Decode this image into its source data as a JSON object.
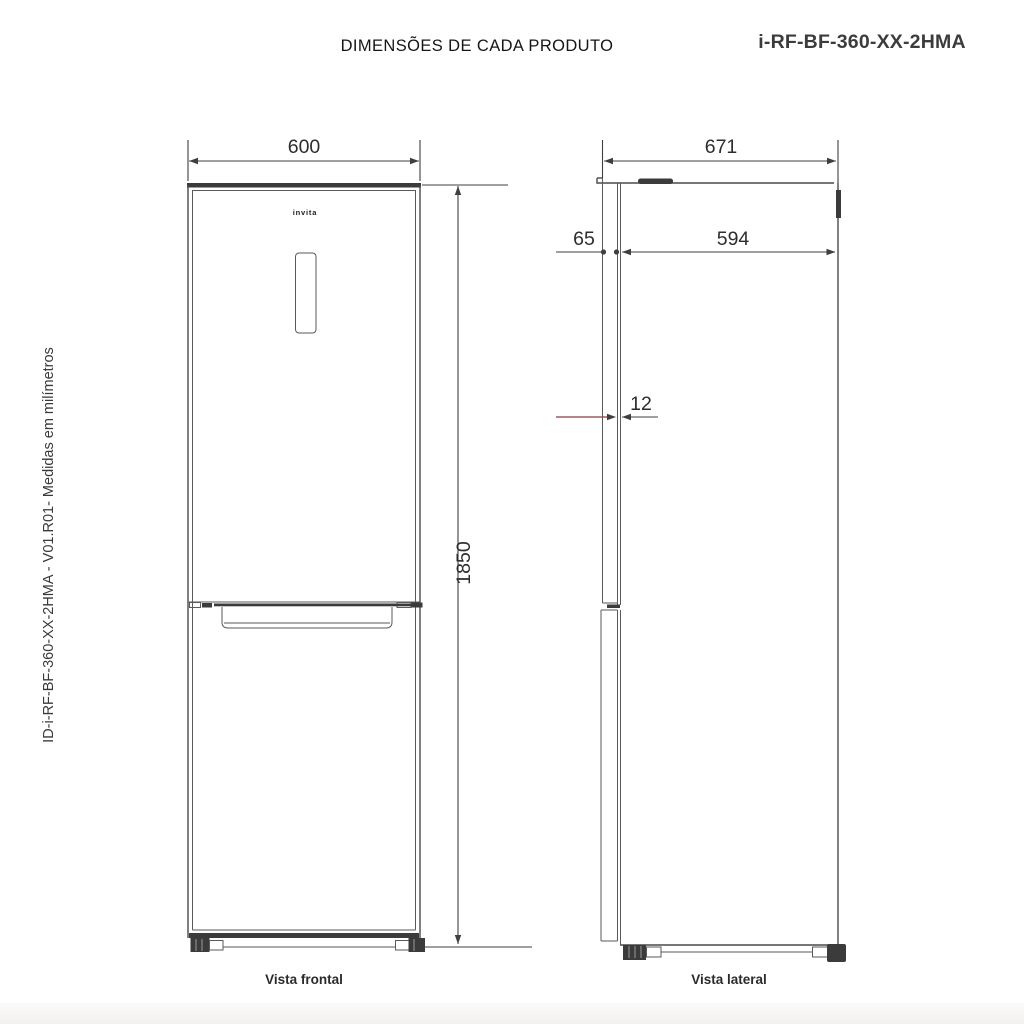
{
  "header": {
    "title": "DIMENSÕES DE CADA PRODUTO",
    "model": "i-RF-BF-360-XX-2HMA",
    "side_note": "ID-i-RF-BF-360-XX-2HMA - V01.R01- Medidas em milímetros"
  },
  "front_view": {
    "label": "Vista frontal",
    "brand": "invita",
    "width_mm": "600",
    "height_mm": "1850"
  },
  "side_view": {
    "label": "Vista lateral",
    "total_depth_mm": "671",
    "cabinet_depth_mm": "594",
    "door_thickness_mm": "65",
    "door_gap_mm": "12"
  },
  "colors": {
    "line": "#4a4a4a",
    "text": "#2d2d2d",
    "accent_red": "#8a3a3a",
    "footer_strip": "#f2f1ee"
  }
}
